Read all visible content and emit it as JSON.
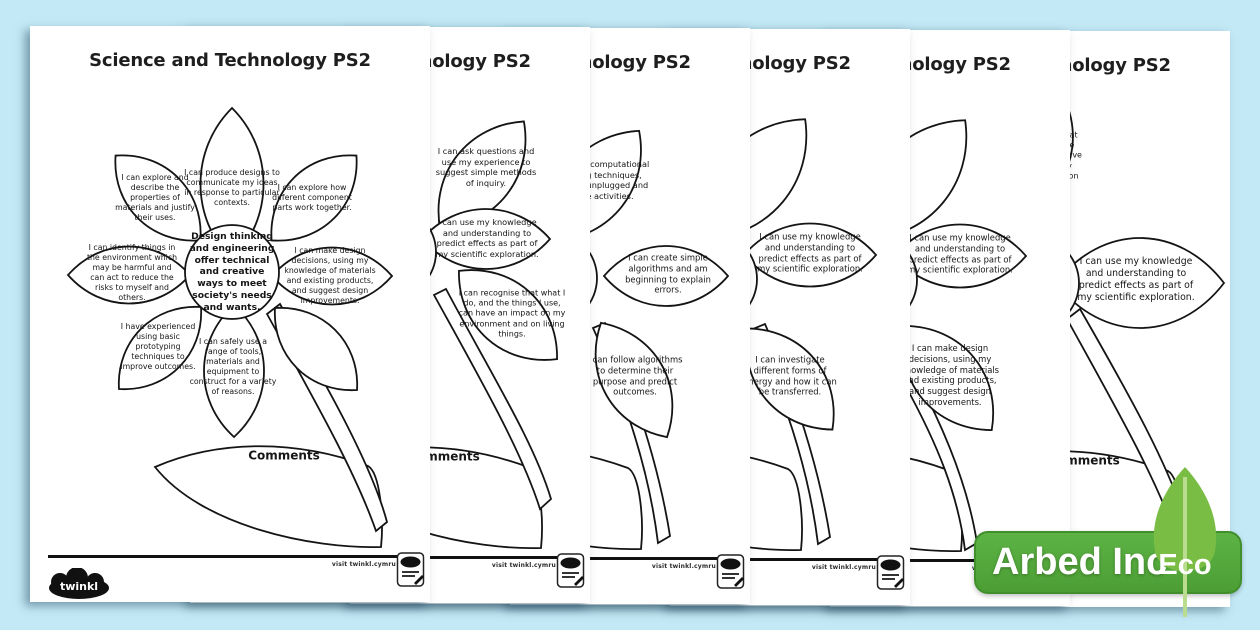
{
  "background_color": "#c3e9f6",
  "eco_badge": {
    "company": "Arbed Inc",
    "eco": "Eco",
    "badge_green": "#4fa537",
    "leaf_green": "#7abd45",
    "leaf_vein": "#b9dc8e"
  },
  "pages": [
    {
      "title": "Science and Technology PS2",
      "center_text": "Design thinking and engineering offer technical and creative ways to meet society's needs and wants.",
      "petals": [
        "I can produce designs to communicate my ideas in response to particular contexts.",
        "I can explore and describe the properties of materials and justify their uses.",
        "I can explore how different component parts work together.",
        "I can identify things in the environment which may be harmful and can act to reduce the risks to myself and others.",
        "I can make design decisions, using my knowledge of materials and existing products, and suggest design improvements.",
        "I have experienced using basic prototyping techniques to improve outcomes.",
        "I can safely use a range of tools, materials and equipment to construct for a variety of reasons.",
        ""
      ],
      "comments_label": "Comments",
      "footer": {
        "visit": "visit twinkl.cymru",
        "logo": "twinkl"
      }
    },
    {
      "title": "Science and Technology PS2",
      "petals": [
        "I can ask questions and use my experience to suggest simple methods of inquiry.",
        "I can use my knowledge and understanding to predict effects as part of my scientific exploration.",
        "I can recognise that what I do, and the things I use, can have an impact on my environment and on living things."
      ],
      "comments_label": "Comments",
      "footer": {
        "visit": "visit twinkl.cymru"
      }
    },
    {
      "title": "Science and Technology PS2",
      "petals": [
        "I can use computational thinking techniques, through unplugged and online activities.",
        "I can create simple algorithms and am beginning to explain errors.",
        "I can follow algorithms to determine their purpose and predict outcomes."
      ],
      "footer": {
        "visit": "visit twinkl.cymru"
      }
    },
    {
      "title": "Science and Technology PS2",
      "petals": [
        "",
        "I can use my knowledge and understanding to predict effects as part of my scientific exploration.",
        "I can investigate different forms of energy and how it can be transferred."
      ],
      "footer": {
        "visit": "visit twinkl.cymru"
      }
    },
    {
      "title": "Science and Technology PS2",
      "petals": [
        "",
        "I can use my knowledge and understanding to predict effects as part of my scientific exploration.",
        "I can make design decisions, using my knowledge of materials and existing products, and suggest design improvements."
      ],
      "footer": {
        "visit": "visit twinkl.cymru"
      }
    },
    {
      "title": "Science and Technology PS2",
      "petals": [
        "I can recognise that what I do, and the things I use, can have an impact on my environment and on living things.",
        "",
        "I can use my knowledge and understanding to predict effects as part of my scientific exploration."
      ],
      "comments_label": "Comments",
      "footer": {}
    }
  ]
}
